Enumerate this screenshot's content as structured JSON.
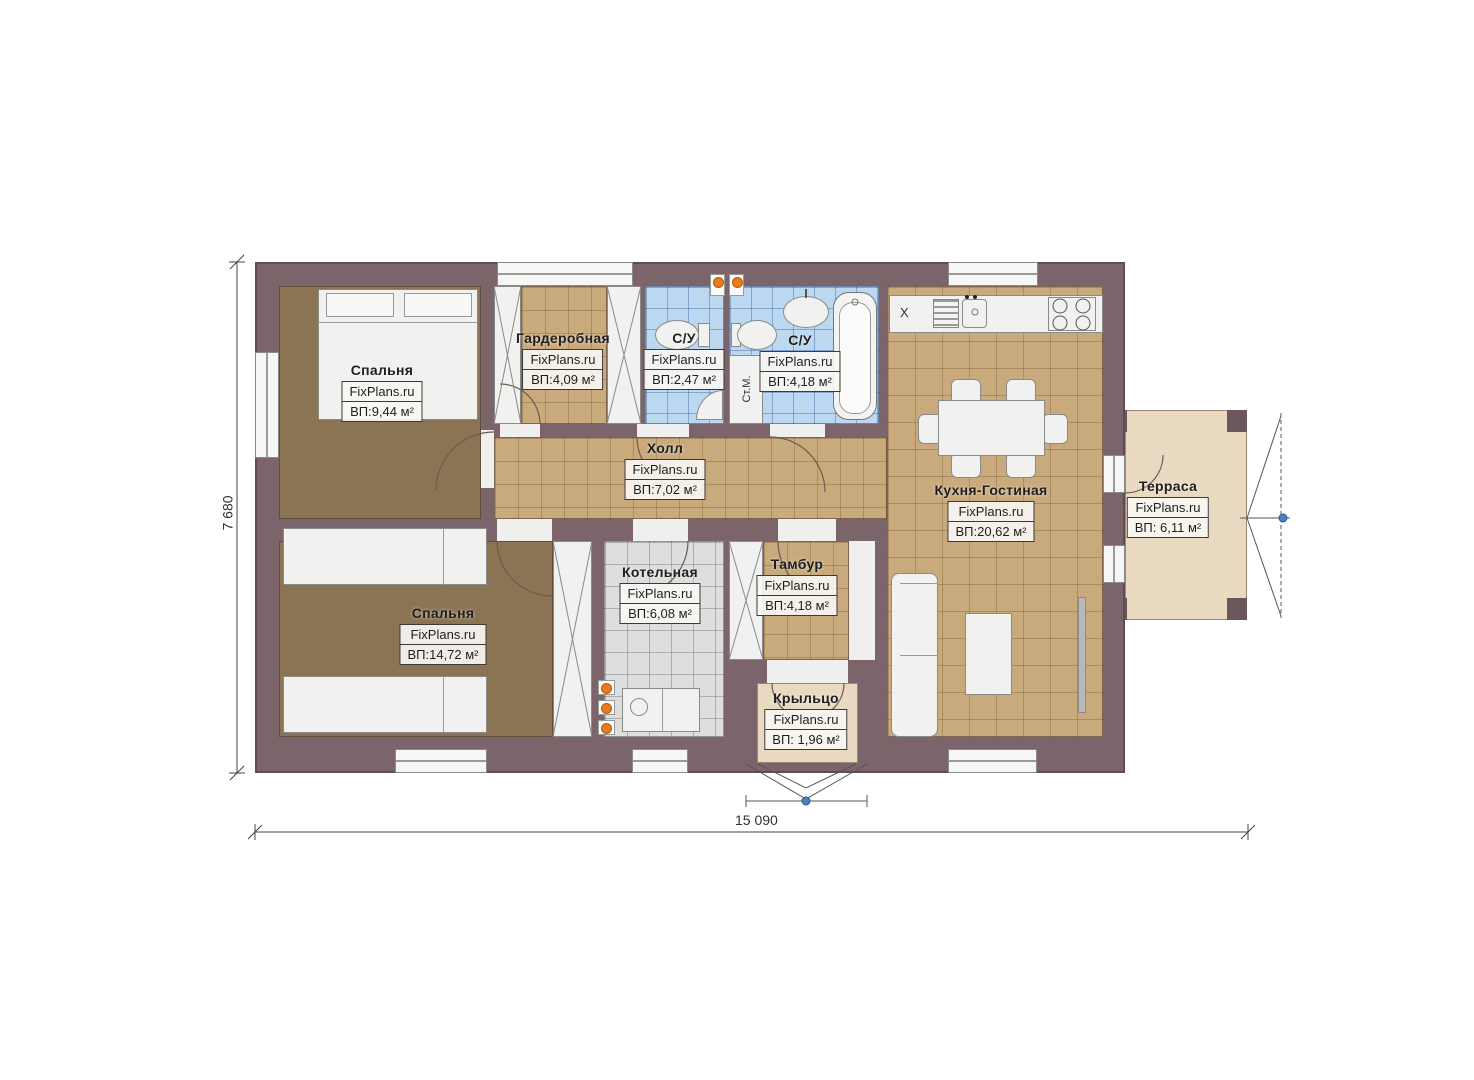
{
  "brand": "FixPlans.ru",
  "rooms": [
    {
      "id": "bedroom-1",
      "name": "Спальня",
      "brand": "FixPlans.ru",
      "area": "ВП:9,44 м²"
    },
    {
      "id": "wardrobe",
      "name": "Гардеробная",
      "brand": "FixPlans.ru",
      "area": "ВП:4,09 м²"
    },
    {
      "id": "bathroom-1",
      "name": "С/У",
      "brand": "FixPlans.ru",
      "area": "ВП:2,47 м²"
    },
    {
      "id": "bathroom-2",
      "name": "С/У",
      "brand": "FixPlans.ru",
      "area": "ВП:4,18 м²"
    },
    {
      "id": "hall",
      "name": "Холл",
      "brand": "FixPlans.ru",
      "area": "ВП:7,02 м²"
    },
    {
      "id": "kitchen-living",
      "name": "Кухня-Гостиная",
      "brand": "FixPlans.ru",
      "area": "ВП:20,62 м²"
    },
    {
      "id": "terrace",
      "name": "Терраса",
      "brand": "FixPlans.ru",
      "area": "ВП: 6,11 м²"
    },
    {
      "id": "bedroom-2",
      "name": "Спальня",
      "brand": "FixPlans.ru",
      "area": "ВП:14,72 м²"
    },
    {
      "id": "boiler-room",
      "name": "Котельная",
      "brand": "FixPlans.ru",
      "area": "ВП:6,08 м²"
    },
    {
      "id": "vestibule",
      "name": "Тамбур",
      "brand": "FixPlans.ru",
      "area": "ВП:4,18 м²"
    },
    {
      "id": "porch",
      "name": "Крыльцо",
      "brand": "FixPlans.ru",
      "area": "ВП: 1,96 м²"
    }
  ],
  "annotations": {
    "washing_machine": "Ст.М.",
    "fridge": "X"
  },
  "dimensions": {
    "overall_width": "15 090",
    "overall_height": "7 680"
  },
  "colors": {
    "wall": "#7b656b",
    "bedroom_floor": "#8b7453",
    "tile_tan": "#c9aa7d",
    "tile_blue": "#bcd7f0",
    "tile_gray": "#dedede",
    "deck_beige": "#ead9c1",
    "accent_orange": "#e87b1e",
    "marker_blue": "#4d7fbe"
  }
}
